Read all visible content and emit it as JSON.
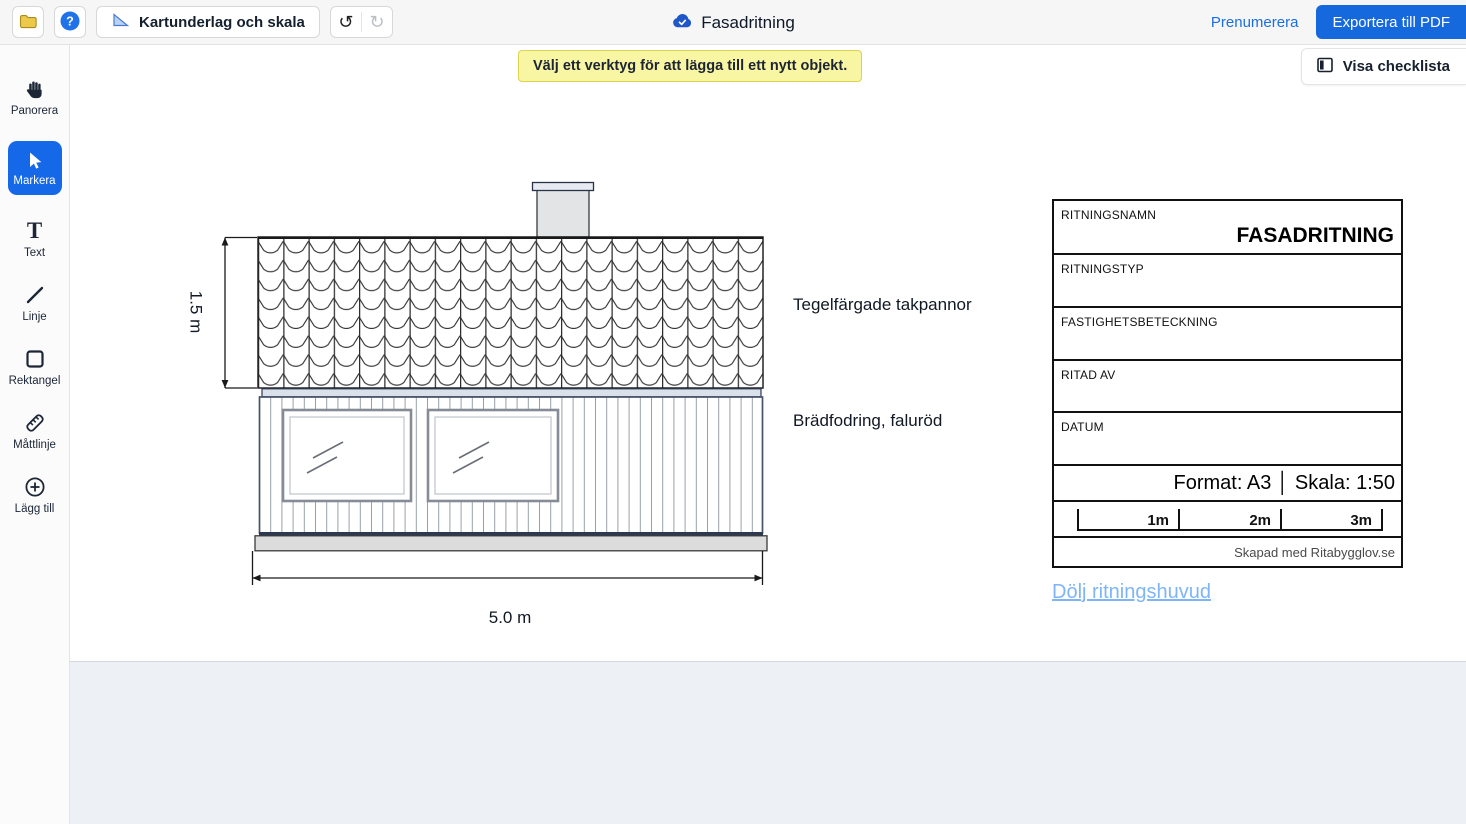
{
  "toolbar": {
    "map_scale_label": "Kartunderlag och skala",
    "doc_title": "Fasadritning",
    "subscribe_label": "Prenumerera",
    "export_label": "Exportera till PDF"
  },
  "banner_text": "Välj ett verktyg för att lägga till ett nytt objekt.",
  "checklist_label": "Visa checklista",
  "sidebar": {
    "items": [
      {
        "label": "Panorera",
        "icon": "hand-icon",
        "active": false
      },
      {
        "label": "Markera",
        "icon": "cursor-icon",
        "active": true
      },
      {
        "label": "Text",
        "icon": "text-icon",
        "active": false
      },
      {
        "label": "Linje",
        "icon": "line-icon",
        "active": false
      },
      {
        "label": "Rektangel",
        "icon": "rectangle-icon",
        "active": false
      },
      {
        "label": "Måttlinje",
        "icon": "measure-icon",
        "active": false
      },
      {
        "label": "Lägg till",
        "icon": "plus-icon",
        "active": false
      }
    ]
  },
  "drawing": {
    "roof_height": "1.5 m",
    "building_width": "5.0 m",
    "roof_note": "Tegelfärgade takpannor",
    "facade_note": "Brädfodring, faluröd"
  },
  "titleblock": {
    "rows": [
      {
        "label": "RITNINGSNAMN",
        "value": "FASADRITNING"
      },
      {
        "label": "RITNINGSTYP",
        "value": ""
      },
      {
        "label": "FASTIGHETSBETECKNING",
        "value": ""
      },
      {
        "label": "RITAD AV",
        "value": ""
      },
      {
        "label": "DATUM",
        "value": ""
      }
    ],
    "format_scale": "Format: A3 │ Skala: 1:50",
    "scalebar_labels": [
      "1m",
      "2m",
      "3m"
    ],
    "credit": "Skapad med Ritabygglov.se",
    "hide_link": "Dölj ritningshuvud"
  },
  "colors": {
    "accent_blue": "#1569e0",
    "banner_yellow": "#f8f5a3",
    "link_light_blue": "#7fb5f6"
  }
}
